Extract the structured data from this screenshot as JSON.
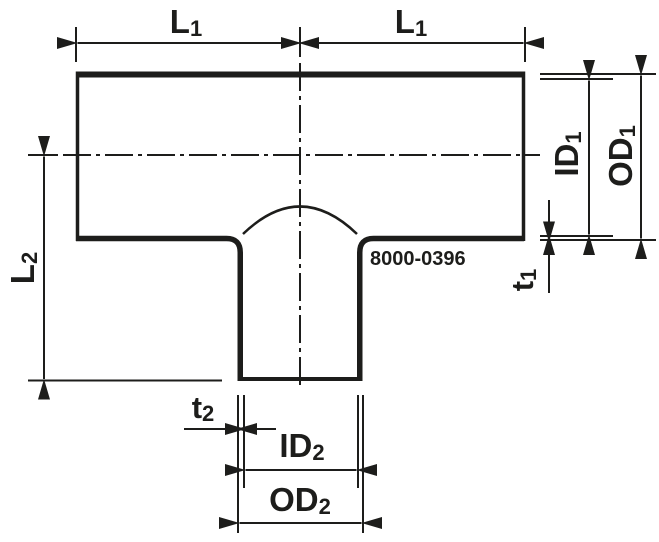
{
  "diagram": {
    "type": "technical-drawing",
    "subject": "reducing-tee-pipe-fitting",
    "part_number": "8000-0396",
    "labels": {
      "l1_left": {
        "main": "L",
        "sub": "1"
      },
      "l1_right": {
        "main": "L",
        "sub": "1"
      },
      "l2": {
        "main": "L",
        "sub": "2"
      },
      "id1": {
        "main": "ID",
        "sub": "1"
      },
      "od1": {
        "main": "OD",
        "sub": "1"
      },
      "t1": {
        "main": "t",
        "sub": "1"
      },
      "t2": {
        "main": "t",
        "sub": "2"
      },
      "id2": {
        "main": "ID",
        "sub": "2"
      },
      "od2": {
        "main": "OD",
        "sub": "2"
      }
    },
    "colors": {
      "line": "#1d1d1b",
      "background": "#ffffff"
    }
  }
}
